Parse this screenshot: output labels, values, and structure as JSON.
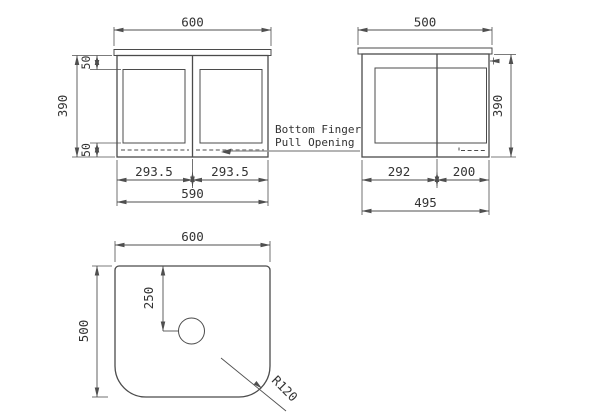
{
  "views": {
    "front": {
      "top_width": "600",
      "height": "390",
      "top_rail": "50",
      "bottom_rail": "50",
      "left_door_width": "293.5",
      "right_door_width": "293.5",
      "cabinet_width": "590"
    },
    "side": {
      "top_width": "500",
      "height": "390",
      "left_door_width": "292",
      "right_door_width": "200",
      "cabinet_width": "495"
    },
    "plan": {
      "width": "600",
      "depth": "500",
      "hole_center_offset": "250",
      "corner_radius_label": "R120"
    }
  },
  "annotations": {
    "finger_pull_line1": "Bottom Finger",
    "finger_pull_line2": "Pull Opening"
  },
  "colors": {
    "object_line": "#4b4b4b",
    "dim_line": "#4f4f4f",
    "text_color": "#333333",
    "leader": "#9b9b9b",
    "background": "#ffffff"
  }
}
